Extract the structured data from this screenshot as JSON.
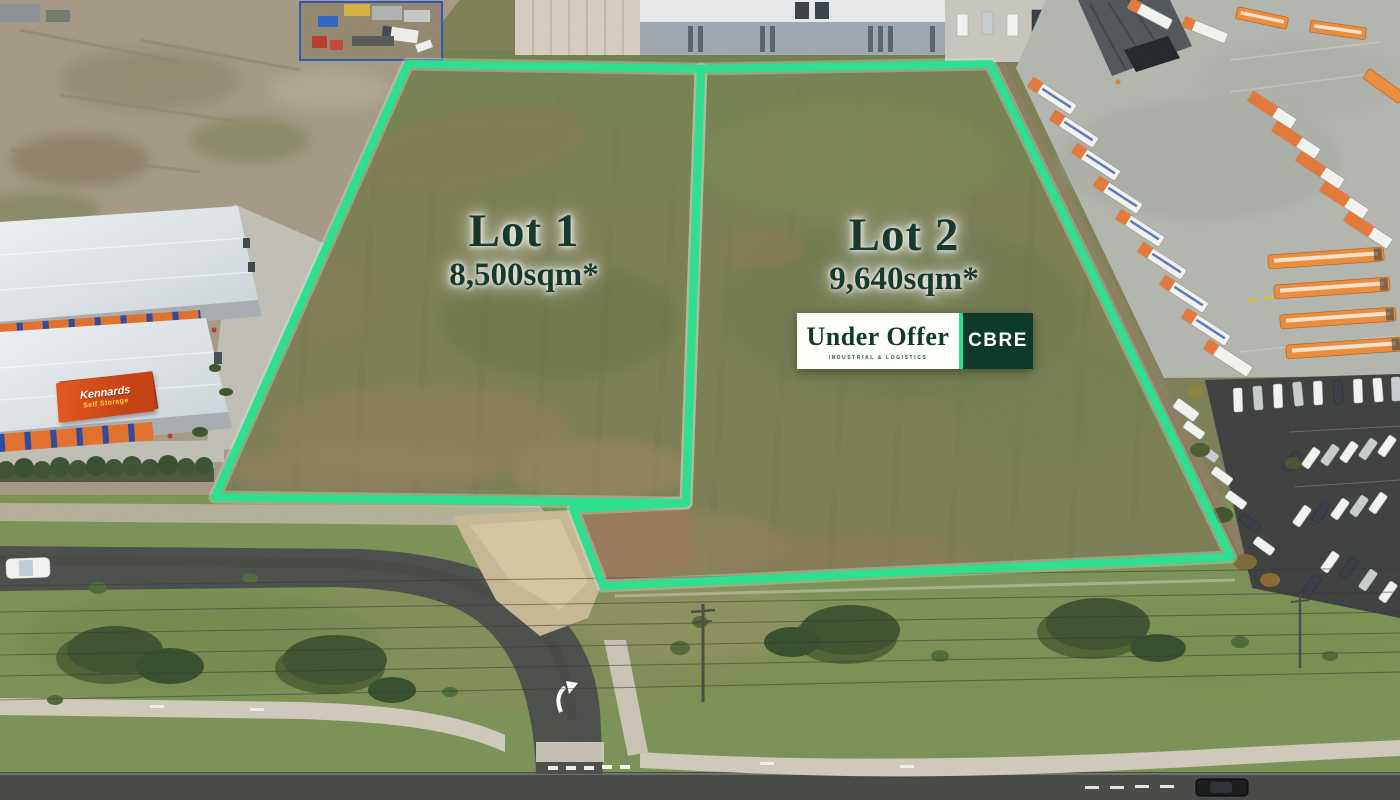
{
  "scene": {
    "description": "Aerial drone photograph of two vacant industrial land lots outlined in bright green, beside a self-storage facility, bus depot and car park"
  },
  "lot1": {
    "title": "Lot 1",
    "area": "8,500sqm*"
  },
  "lot2": {
    "title": "Lot 2",
    "area": "9,640sqm*"
  },
  "badge": {
    "status": "Under Offer",
    "division": "INDUSTRIAL & LOGISTICS",
    "brand": "CBRE"
  },
  "signs": {
    "kennards_top": "Kennards",
    "kennards_bottom": "Self Storage"
  },
  "colors": {
    "boundary_green": "#2BE08E",
    "label_green": "#18392D",
    "cbre_panel_green": "#0D3A2B",
    "badge_background": "#FDFDFA",
    "kennards_orange": "#D94D1D"
  }
}
